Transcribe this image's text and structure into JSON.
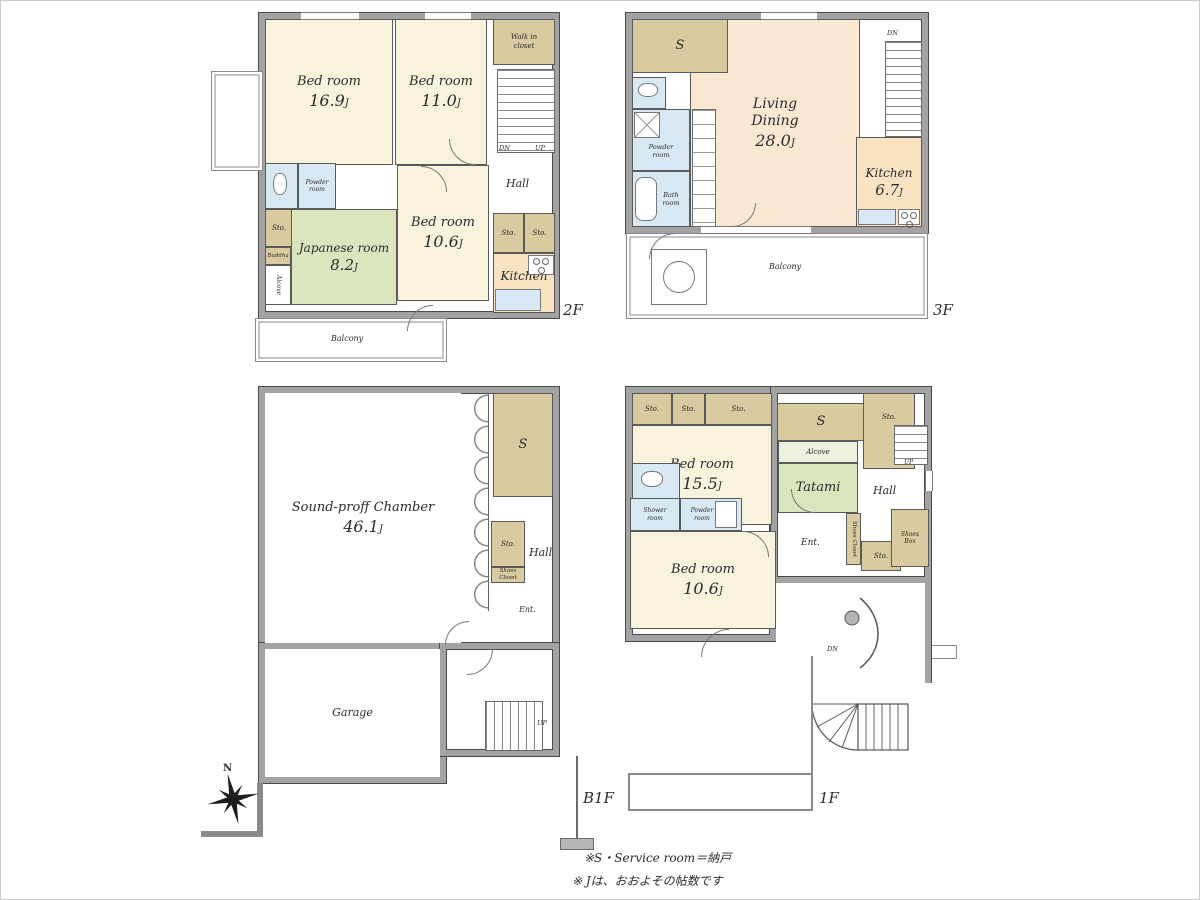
{
  "units": {
    "area": "J"
  },
  "compass": {
    "north": "N"
  },
  "notes": {
    "service_room": "※S・Service room＝納戸",
    "tatami_count": "※ Jは、おおよその帖数です"
  },
  "floors": {
    "f2": {
      "label": "2F",
      "dn": "DN",
      "up": "UP",
      "rooms": {
        "bed1": {
          "name": "Bed room",
          "area": "16.9"
        },
        "bed2": {
          "name": "Bed room",
          "area": "11.0"
        },
        "wic": {
          "name": "Walk in\ncloset"
        },
        "hall": {
          "name": "Hall"
        },
        "powder": {
          "name": "Powder\nroom"
        },
        "sto1": {
          "name": "Sto."
        },
        "buddha": {
          "name": "Buddha"
        },
        "alcove": {
          "name": "Alcove"
        },
        "japanese": {
          "name": "Japanese room",
          "area": "8.2"
        },
        "bed3": {
          "name": "Bed room",
          "area": "10.6"
        },
        "sto2": {
          "name": "Sto."
        },
        "sto3": {
          "name": "Sto."
        },
        "kitchen": {
          "name": "Kitchen"
        },
        "balcony": {
          "name": "Balcony"
        }
      }
    },
    "f3": {
      "label": "3F",
      "dn": "DN",
      "rooms": {
        "s": {
          "name": "S"
        },
        "living": {
          "name": "Living\nDining",
          "area": "28.0"
        },
        "kitchen": {
          "name": "Kitchen",
          "area": "6.7"
        },
        "powder": {
          "name": "Powder\nroom"
        },
        "bath": {
          "name": "Bath\nroom"
        },
        "balcony": {
          "name": "Balcony"
        }
      }
    },
    "b1f": {
      "label": "B1F",
      "up": "UP",
      "rooms": {
        "chamber": {
          "name": "Sound-proff Chamber",
          "area": "46.1"
        },
        "s": {
          "name": "S"
        },
        "sto": {
          "name": "Sto."
        },
        "shoes_closet": {
          "name": "Shoes Closet"
        },
        "hall": {
          "name": "Hall"
        },
        "ent": {
          "name": "Ent."
        },
        "garage": {
          "name": "Garage"
        }
      }
    },
    "f1": {
      "label": "1F",
      "dn": "DN",
      "up": "UP",
      "rooms": {
        "sto1": {
          "name": "Sto."
        },
        "sto2": {
          "name": "Sto."
        },
        "sto3": {
          "name": "Sto."
        },
        "s": {
          "name": "S"
        },
        "sto4": {
          "name": "Sto."
        },
        "bed1": {
          "name": "Bed room",
          "area": "15.5"
        },
        "alcove": {
          "name": "Alcove"
        },
        "tatami": {
          "name": "Tatami"
        },
        "hall": {
          "name": "Hall"
        },
        "shower": {
          "name": "Shower\nroom"
        },
        "powder": {
          "name": "Powder\nroom"
        },
        "bed2": {
          "name": "Bed room",
          "area": "10.6"
        },
        "ent": {
          "name": "Ent."
        },
        "shoes_closet": {
          "name": "Shoes Closet"
        },
        "sto5": {
          "name": "Sto."
        },
        "shoes_box": {
          "name": "Shoes\nBox"
        }
      }
    }
  }
}
